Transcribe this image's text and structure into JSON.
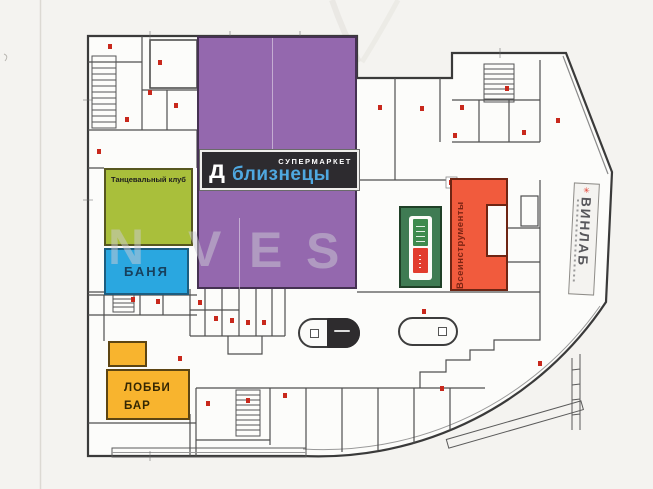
{
  "zones": {
    "supermarket": {
      "sign_top": "СУПЕРМАРКЕТ",
      "brand": "близнецы",
      "logo_letter": "д"
    },
    "dance_club": {
      "label": "Танцевальный клуб"
    },
    "banya": {
      "label": "БАНЯ"
    },
    "lobby_bar": {
      "line1": "ЛОББИ",
      "line2": "БАР"
    },
    "tools": {
      "label": "Всеинструменты"
    },
    "winlab": {
      "label": "ВИНЛАБ",
      "logo_glyph": "✳"
    }
  },
  "watermark": {
    "letters": [
      "N",
      "V",
      "E",
      "S"
    ]
  },
  "colors": {
    "paper": "#f4f3f0",
    "building": "#fcfcfa",
    "walls": "#4a4a4a",
    "zone_purple": "#9468ae",
    "sign_black": "#2d2b2f",
    "brand_blue": "#4fa8e0",
    "zone_green": "#a9bf3b",
    "zone_blue": "#2aa7e0",
    "zone_orange": "#f8b42e",
    "zone_red": "#f15b3d",
    "store_green": "#3f7b53",
    "banner_red": "#e23c2e",
    "marker_red": "#c8281c",
    "winlab_bg": "#f4f3f0"
  }
}
